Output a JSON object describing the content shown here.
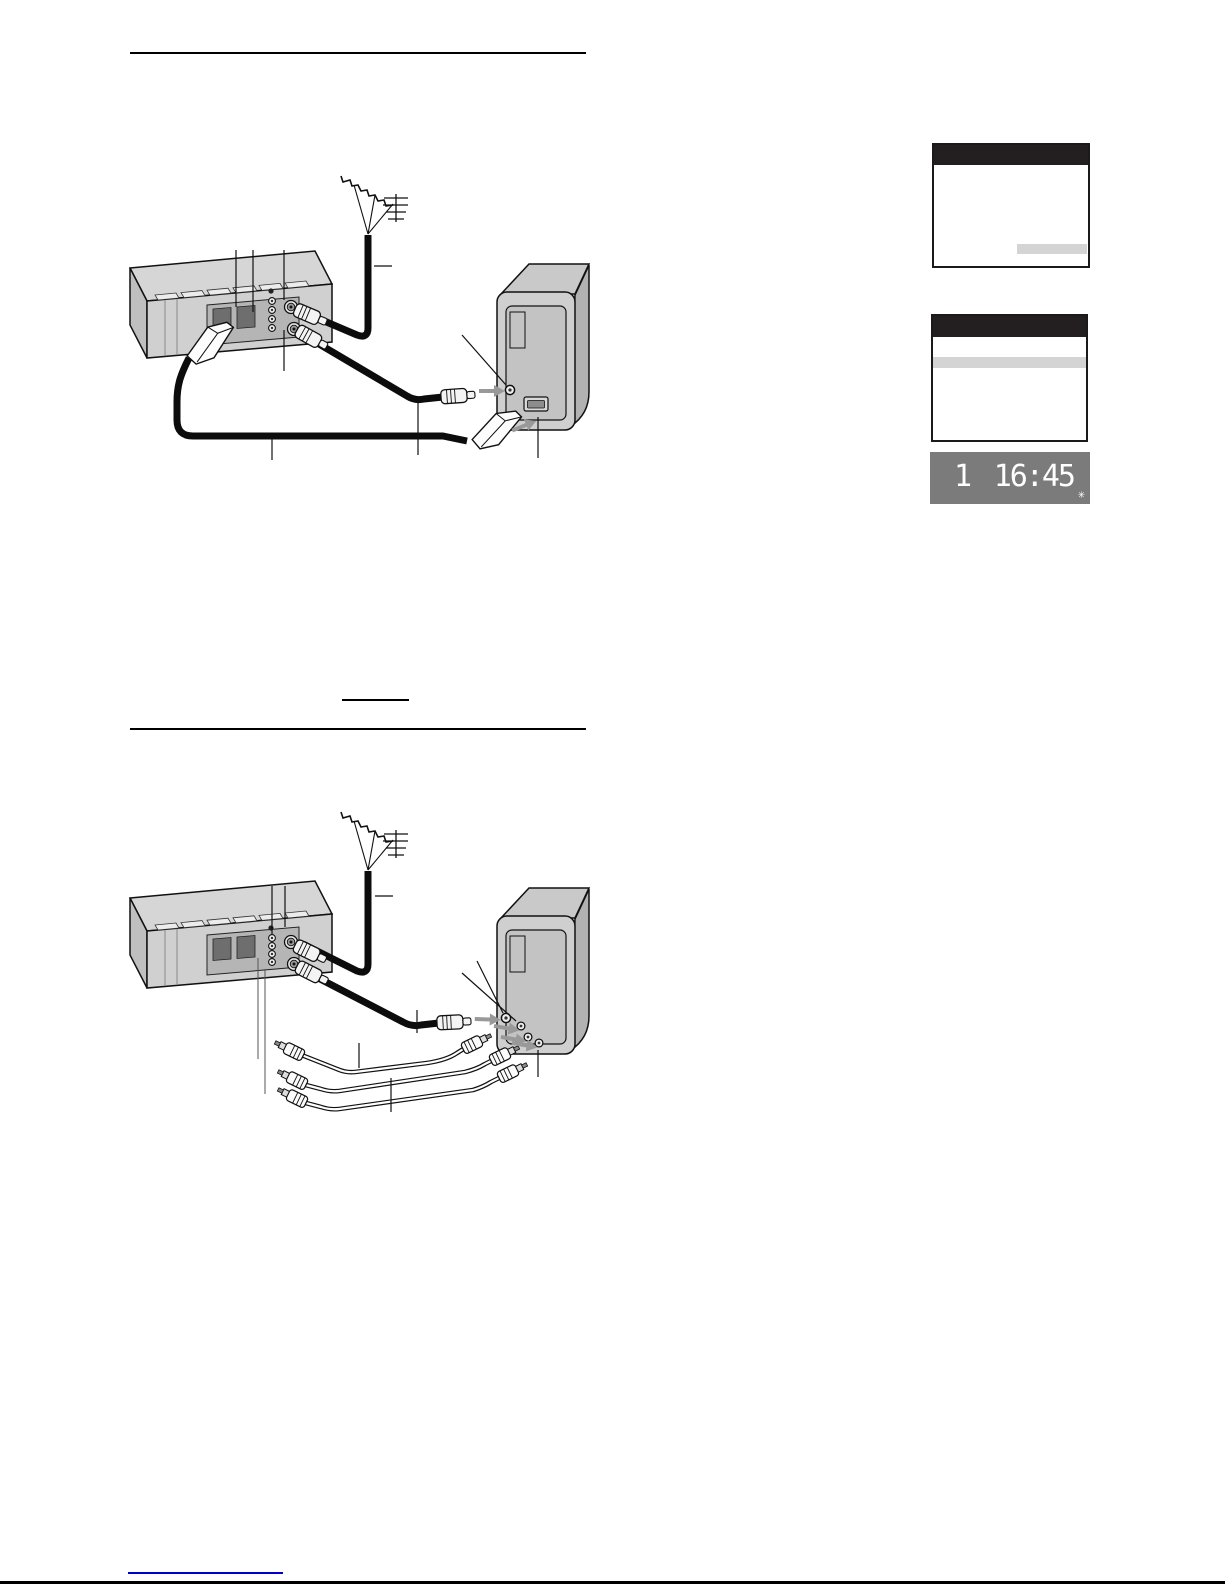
{
  "display_panel": {
    "program_position": "1",
    "time": "16:45",
    "blink_symbol": "✳"
  },
  "menu_screens": [
    {
      "name": "tv-menu-screen-blank",
      "highlight_position": "bottom-right"
    },
    {
      "name": "tv-menu-screen-blank",
      "highlight_position": "top-row"
    }
  ],
  "figures": [
    {
      "name": "aerial-and-scart-cable-connection-diagram"
    },
    {
      "name": "aerial-and-av-phono-cable-connection-diagram"
    }
  ],
  "icons": {
    "antenna": "aerial-antenna-icon",
    "arrow": "gray-insert-arrow-icon"
  },
  "colors": {
    "screen_title_bar": "#231f20",
    "screen_highlight": "#d4d4d4",
    "display_background": "#7b7b7b",
    "display_digits": "#ffffff",
    "footer_link_line": "#0000cc",
    "line_art": "#111111",
    "device_body": "#d0d0d0"
  }
}
